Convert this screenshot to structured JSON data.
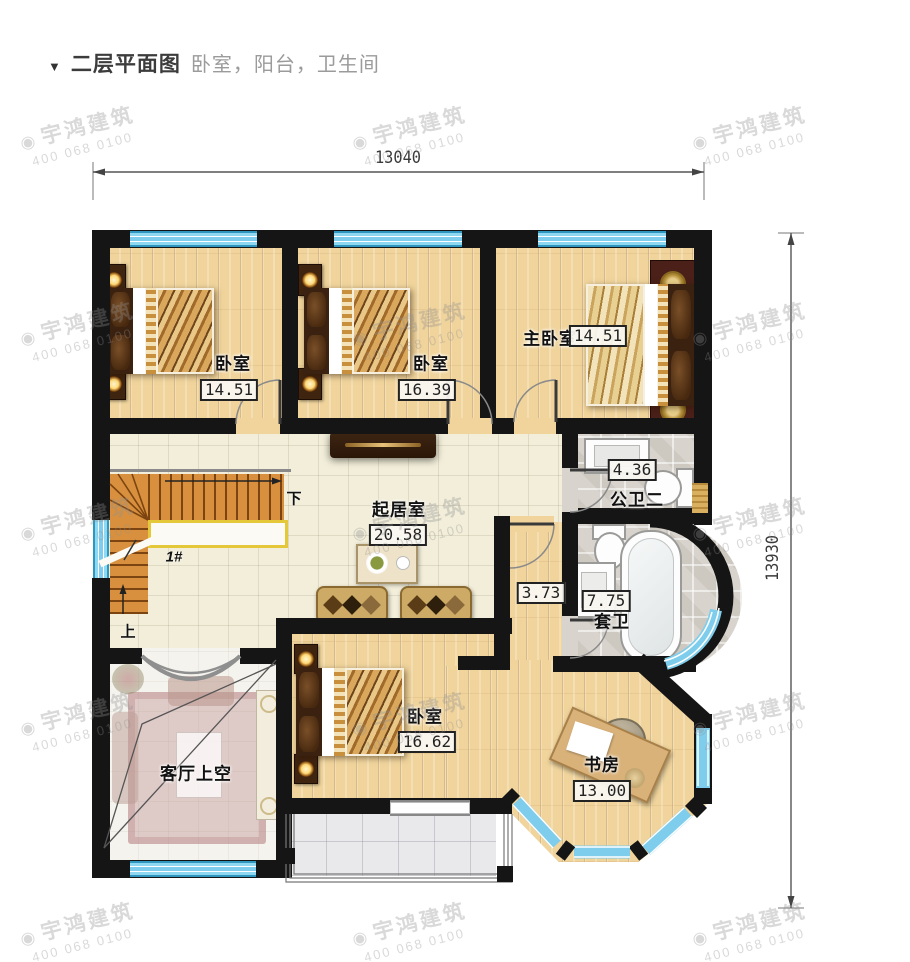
{
  "header": {
    "marker": "▼",
    "title": "二层平面图",
    "subtitle": "卧室，阳台，卫生间"
  },
  "dimensions": {
    "top": "13040",
    "right": "13930"
  },
  "rooms": {
    "bedroom1": {
      "name": "卧室",
      "area": "14.51"
    },
    "bedroom2": {
      "name": "卧室",
      "area": "16.39"
    },
    "master": {
      "name": "主卧室",
      "area": "14.51"
    },
    "bath_public": {
      "name": "公卫二",
      "area": "4.36"
    },
    "living": {
      "name": "起居室",
      "area": "20.58"
    },
    "hall": {
      "area": "3.73"
    },
    "bath_suite": {
      "name": "套卫",
      "area": "7.75"
    },
    "bedroom3": {
      "name": "卧室",
      "area": "16.62"
    },
    "study": {
      "name": "书房",
      "area": "13.00"
    },
    "void": {
      "name": "客厅上空"
    }
  },
  "stairs": {
    "label": "1#",
    "down": "下",
    "up": "上"
  },
  "watermark": {
    "logo": "◉",
    "brand": "宇鸿建筑",
    "phone": "400 068 0100"
  },
  "colors": {
    "wall": "#151515",
    "window": "#7ecdec",
    "wood_floor": "#f0d49c",
    "tile_floor": "#f2eeda",
    "bath_floor": "#d8d4cd",
    "stair_wood": "#d8903e",
    "rail_yellow": "#e4c83a",
    "title_text": "#3c3c3c",
    "subtitle_text": "#9b9b9b"
  }
}
